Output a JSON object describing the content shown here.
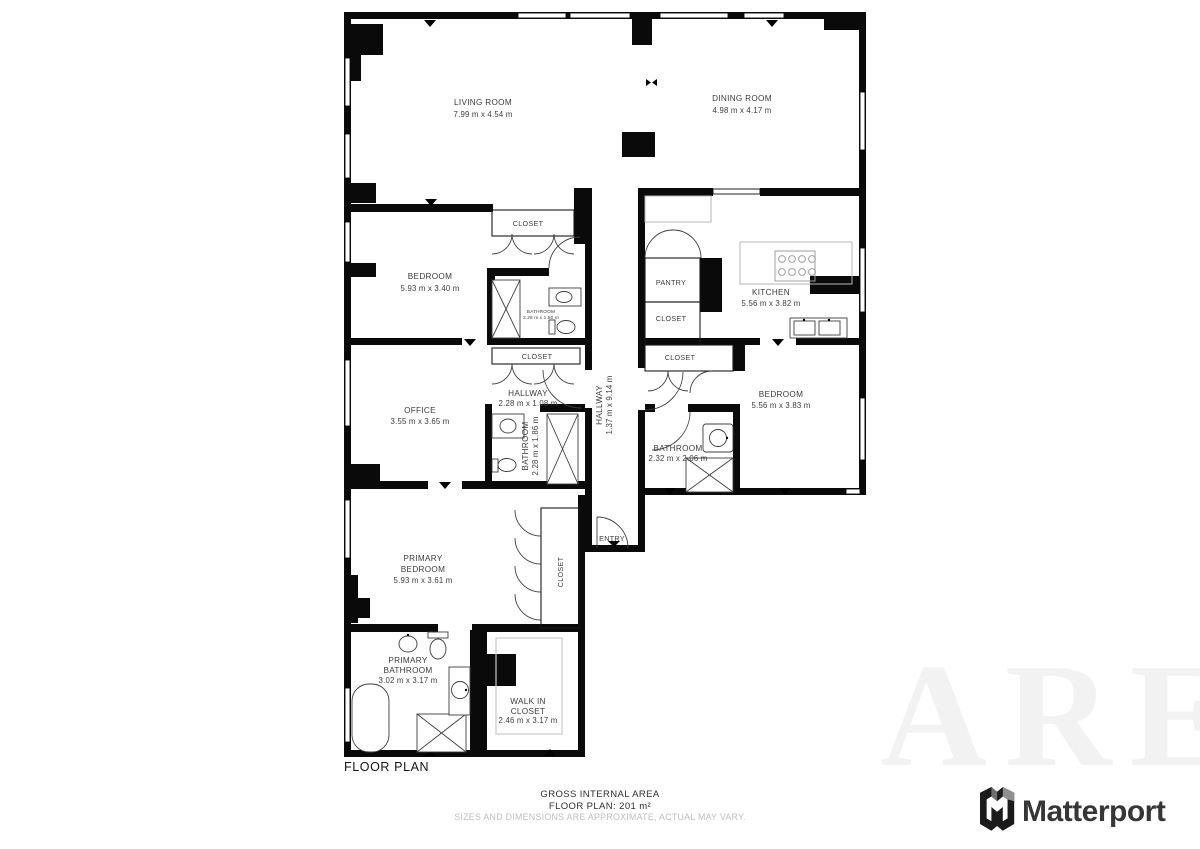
{
  "plan": {
    "title": "FLOOR PLAN",
    "rooms": {
      "living_room": {
        "name": "LIVING ROOM",
        "dims": "7.99 m x 4.54 m"
      },
      "dining_room": {
        "name": "DINING ROOM",
        "dims": "4.98 m x 4.17 m"
      },
      "bedroom_top": {
        "name": "BEDROOM",
        "dims": "5.93 m x 3.40 m"
      },
      "closet_bedroom_top": {
        "name": "CLOSET"
      },
      "bathroom_small": {
        "name": "BATHROOM",
        "dims": "2.28 m x 1.50 m"
      },
      "pantry": {
        "name": "PANTRY"
      },
      "closet_kitchen": {
        "name": "CLOSET"
      },
      "kitchen": {
        "name": "KITCHEN",
        "dims": "5.56 m x 3.82 m"
      },
      "closet_hall": {
        "name": "CLOSET"
      },
      "hallway_small": {
        "name": "HALLWAY",
        "dims": "2.28 m x 1.08 m"
      },
      "hallway_main": {
        "name": "HALLWAY",
        "dims": "1.37 m x 9.14 m"
      },
      "office": {
        "name": "OFFICE",
        "dims": "3.55 m x 3.65 m"
      },
      "bathroom_hall": {
        "name": "BATHROOM",
        "dims": "2.28 m x 1.86 m"
      },
      "closet_bedroom_right": {
        "name": "CLOSET"
      },
      "bedroom_right": {
        "name": "BEDROOM",
        "dims": "5.56 m x 3.83 m"
      },
      "bathroom_right": {
        "name": "BATHROOM",
        "dims": "2.32 m x 2.06 m"
      },
      "entry": {
        "name": "ENTRY"
      },
      "closet_primary": {
        "name": "CLOSET"
      },
      "primary_bedroom": {
        "name_line1": "PRIMARY",
        "name_line2": "BEDROOM",
        "dims": "5.93 m x 3.61 m"
      },
      "primary_bathroom": {
        "name_line1": "PRIMARY",
        "name_line2": "BATHROOM",
        "dims": "3.02 m x 3.17 m"
      },
      "walk_in_closet": {
        "name_line1": "WALK IN",
        "name_line2": "CLOSET",
        "dims": "2.46 m x 3.17 m"
      }
    }
  },
  "footer": {
    "area_line1": "GROSS INTERNAL AREA",
    "area_line2": "FLOOR PLAN: 201 m²",
    "disclaimer": "SIZES AND DIMENSIONS ARE APPROXIMATE, ACTUAL MAY VARY."
  },
  "branding": {
    "logo_text": "Matterport",
    "watermark_text": "ARE"
  },
  "colors": {
    "walls": "#0a0a0a",
    "label_text": "#3b3b3b",
    "disclaimer_text": "#bdbdbd",
    "watermark": "#f2f2f2",
    "brand_text": "#363636"
  }
}
